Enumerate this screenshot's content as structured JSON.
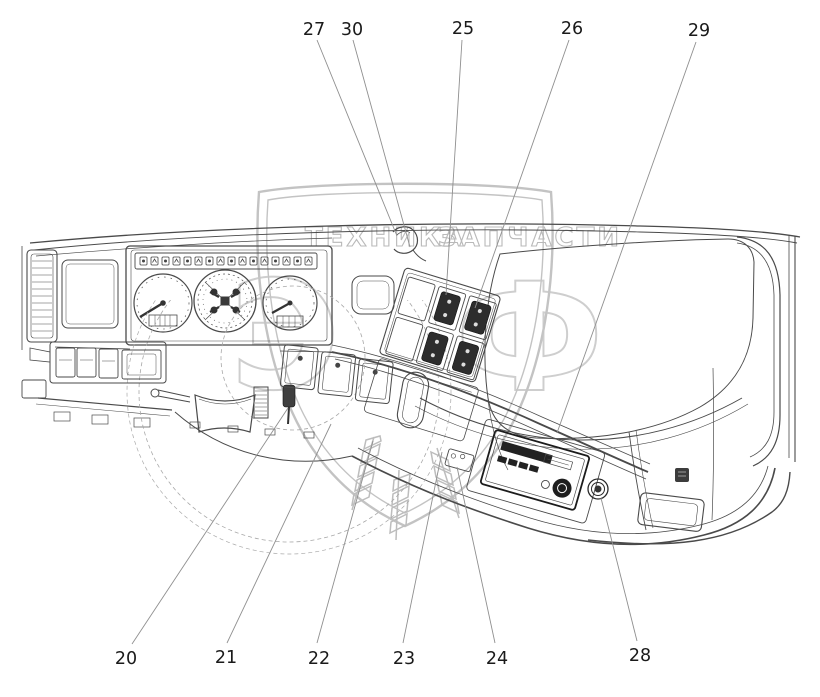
{
  "figure": {
    "type": "technical line diagram",
    "subject": "Vehicle instrument panel (dashboard) with numbered callouts"
  },
  "watermark": {
    "left_text": "ТЕХНИКА",
    "right_text": "ЗАПЧАСТИ",
    "monogram_left": "Э",
    "monogram_right": "Ф"
  },
  "callouts": [
    {
      "number": "20"
    },
    {
      "number": "21"
    },
    {
      "number": "22"
    },
    {
      "number": "23"
    },
    {
      "number": "24"
    },
    {
      "number": "25"
    },
    {
      "number": "26"
    },
    {
      "number": "27"
    },
    {
      "number": "28"
    },
    {
      "number": "29"
    },
    {
      "number": "30"
    }
  ],
  "colors": {
    "background": "#ffffff",
    "diagram_line": "#4a4a4a",
    "dark_fill": "#2d2d2d",
    "callout_line": "#8f8f8f",
    "label": "#1a1a1a",
    "watermark": "#bdbdbd"
  }
}
